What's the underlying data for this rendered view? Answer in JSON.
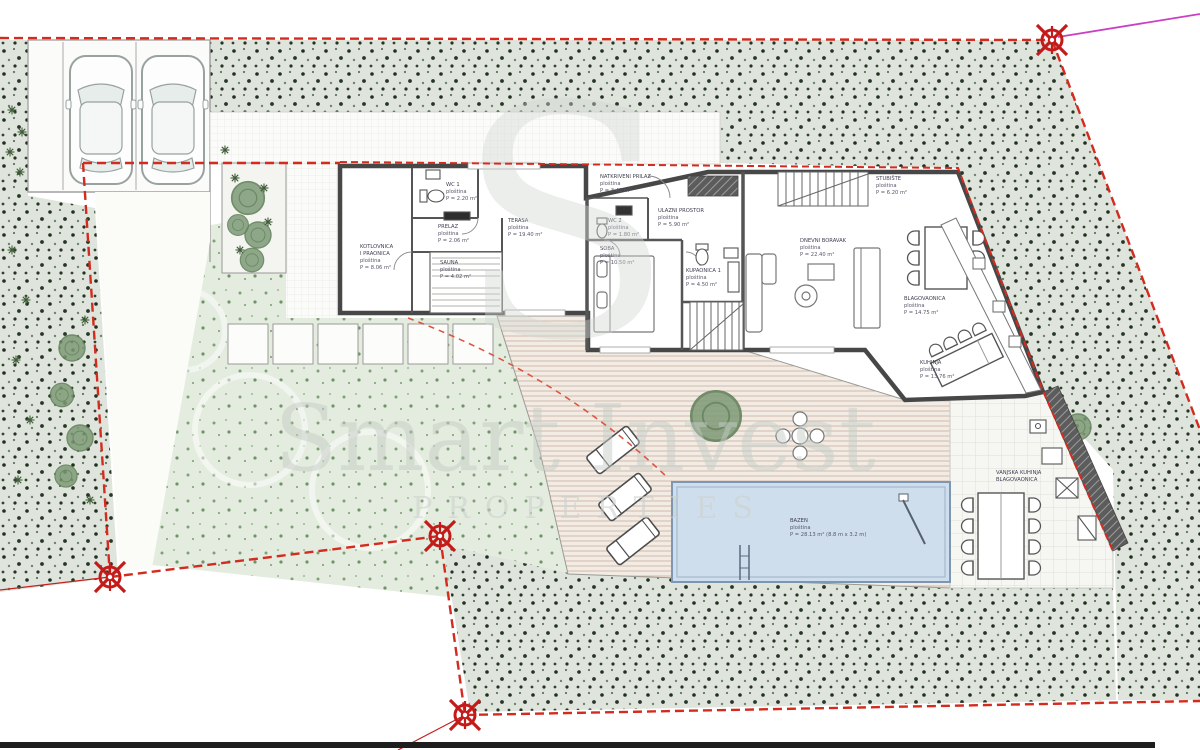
{
  "watermark": {
    "monogram": "S",
    "line1": "Smart Invest",
    "line2": "PROPERTIES"
  },
  "colors": {
    "boundary_red": "#d42b1f",
    "marker_red": "#c41a1a",
    "magenta_line": "#ca3fc3",
    "pool_fill": "#cfdeec",
    "stipple_green": "#dfe5dd",
    "deck_tan": "#f2ece4"
  },
  "rooms": {
    "kotlovnica": {
      "name": "KOTLOVNICA",
      "name2": "I PRAONICA",
      "sub": "ploština",
      "area": "P = 8.06 m²"
    },
    "wc1": {
      "name": "WC 1",
      "sub": "ploština",
      "area": "P = 2.20 m²"
    },
    "prelaz": {
      "name": "PRELAZ",
      "sub": "ploština",
      "area": "P = 2.06 m²"
    },
    "terasa": {
      "name": "TERASA",
      "sub": "ploština",
      "area": "P = 19.40 m²"
    },
    "sauna": {
      "name": "SAUNA",
      "sub": "ploština",
      "area": "P = 4.02 m²"
    },
    "natkriveni_prilaz": {
      "name": "NATKRIVENI PRILAZ",
      "sub": "ploština",
      "area": "P = 3.41 m²"
    },
    "ulazni_prostor": {
      "name": "ULAZNI PROSTOR",
      "sub": "ploština",
      "area": "P = 5.90 m²"
    },
    "wc2": {
      "name": "WC 2",
      "sub": "ploština",
      "area": "P = 1.80 m²"
    },
    "soba": {
      "name": "SOBA",
      "sub": "ploština",
      "area": "P = 10.50 m²"
    },
    "kupaonica": {
      "name": "KUPAONICA 1",
      "sub": "ploština",
      "area": "P = 4.50 m²"
    },
    "stubiste": {
      "name": "STUBIŠTE",
      "sub": "ploština",
      "area": "P = 6.20 m²"
    },
    "dnevni_boravak": {
      "name": "DNEVNI BORAVAK",
      "sub": "ploština",
      "area": "P = 22.40 m²"
    },
    "blagovaonica": {
      "name": "BLAGOVAONICA",
      "sub": "ploština",
      "area": "P = 14.75 m²"
    },
    "kuhinja": {
      "name": "KUHINJA",
      "sub": "ploština",
      "area": "P = 13.76 m²"
    },
    "vanjska_kuhinja": {
      "name": "VANJSKA KUHINJA",
      "name2": "BLAGOVAONICA"
    },
    "bazen": {
      "name": "BAZEN",
      "sub": "ploština",
      "area": "P = 28.13 m² (8.8 m x 3.2 m)"
    }
  }
}
